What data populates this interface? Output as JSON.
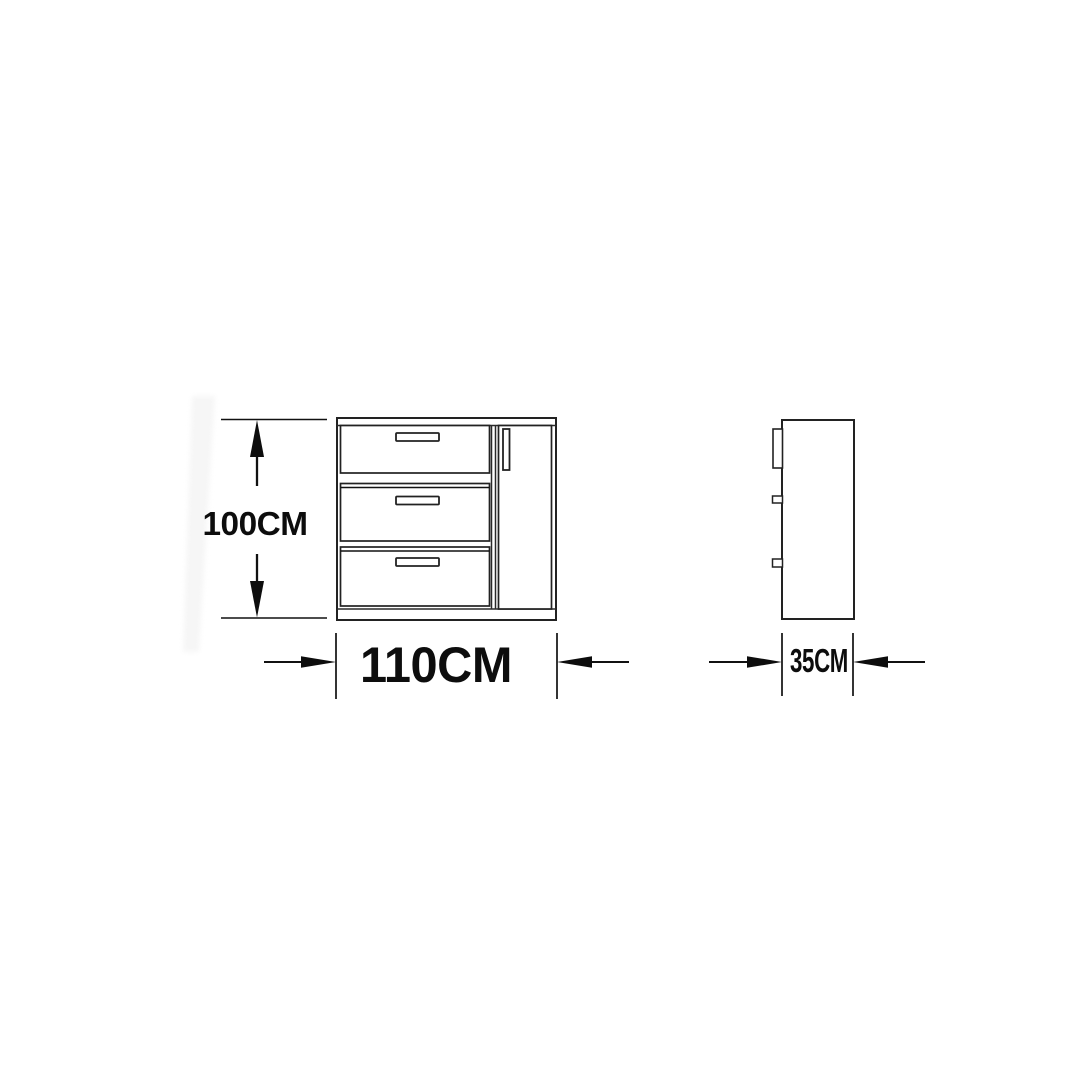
{
  "colors": {
    "background": "#ffffff",
    "line": "#222222",
    "text": "#0d0d0d"
  },
  "views": {
    "front": {
      "drawer_count": 3,
      "door_count": 1
    },
    "side": {
      "handle_profile_count": 3
    }
  },
  "dimensions": {
    "height": {
      "label": "100CM",
      "value": 100,
      "unit": "CM"
    },
    "width": {
      "label": "110CM",
      "value": 110,
      "unit": "CM"
    },
    "depth": {
      "label": "35CM",
      "value": 35,
      "unit": "CM"
    }
  }
}
